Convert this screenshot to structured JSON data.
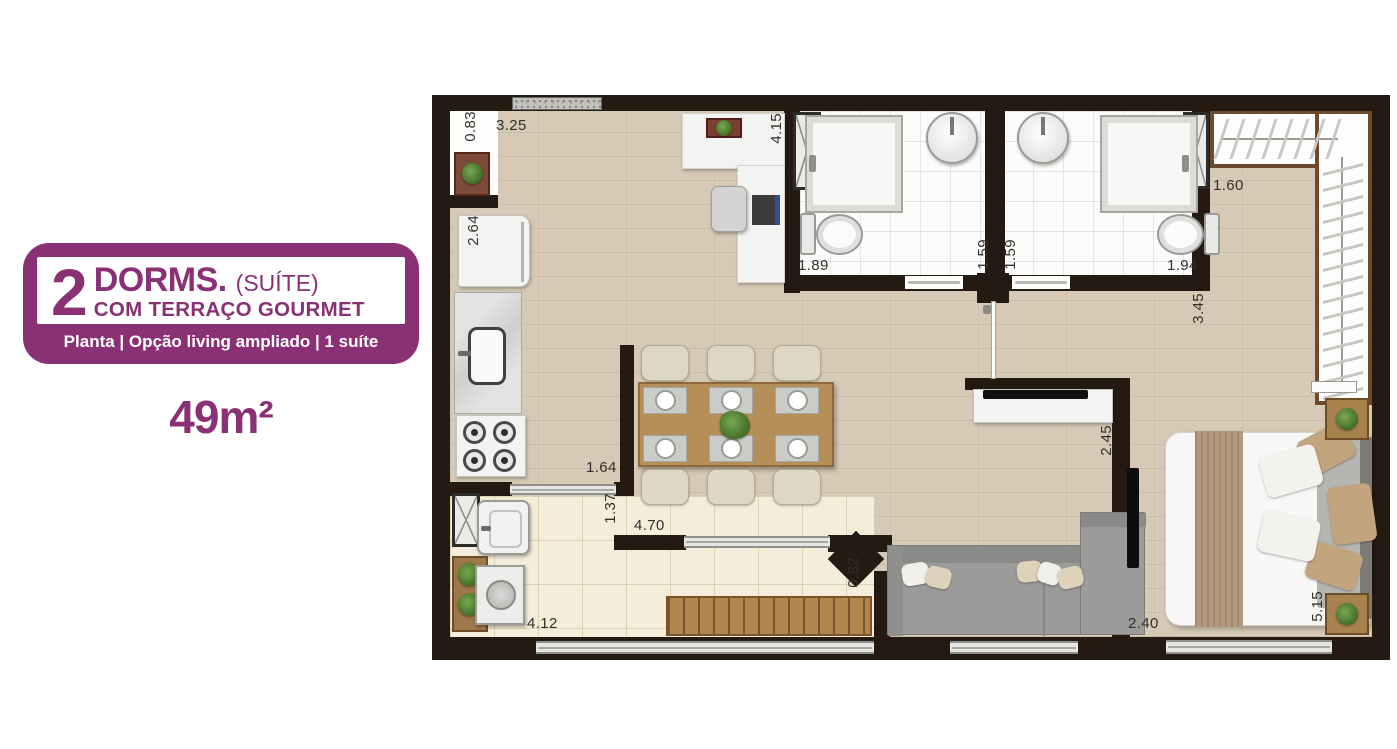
{
  "info_panel": {
    "badge": {
      "number": "2",
      "dorms": "DORMS.",
      "suite": "(SUÍTE)",
      "line2": "COM TERRAÇO GOURMET",
      "caption": "Planta  | Opção  living ampliado | 1 suíte",
      "area": "49m²"
    }
  },
  "colors": {
    "purple": "#8a3074",
    "wall": "#241a12",
    "wood_floor": "#d6c9b5",
    "tile_floor": "#f4edda",
    "table_wood": "#b68e57"
  },
  "floor_plan": {
    "dimension_labels": [
      {
        "text": "0.83"
      },
      {
        "text": "3.25"
      },
      {
        "text": "2.64"
      },
      {
        "text": "4.15"
      },
      {
        "text": "1.89"
      },
      {
        "text": "1.59"
      },
      {
        "text": "1.59"
      },
      {
        "text": "1.94"
      },
      {
        "text": "1.60"
      },
      {
        "text": "3.45"
      },
      {
        "text": "2.45"
      },
      {
        "text": "1.64"
      },
      {
        "text": "1.37"
      },
      {
        "text": "4.70"
      },
      {
        "text": "0.82"
      },
      {
        "text": "4.12"
      },
      {
        "text": "2.40"
      },
      {
        "text": "5.15"
      }
    ]
  }
}
